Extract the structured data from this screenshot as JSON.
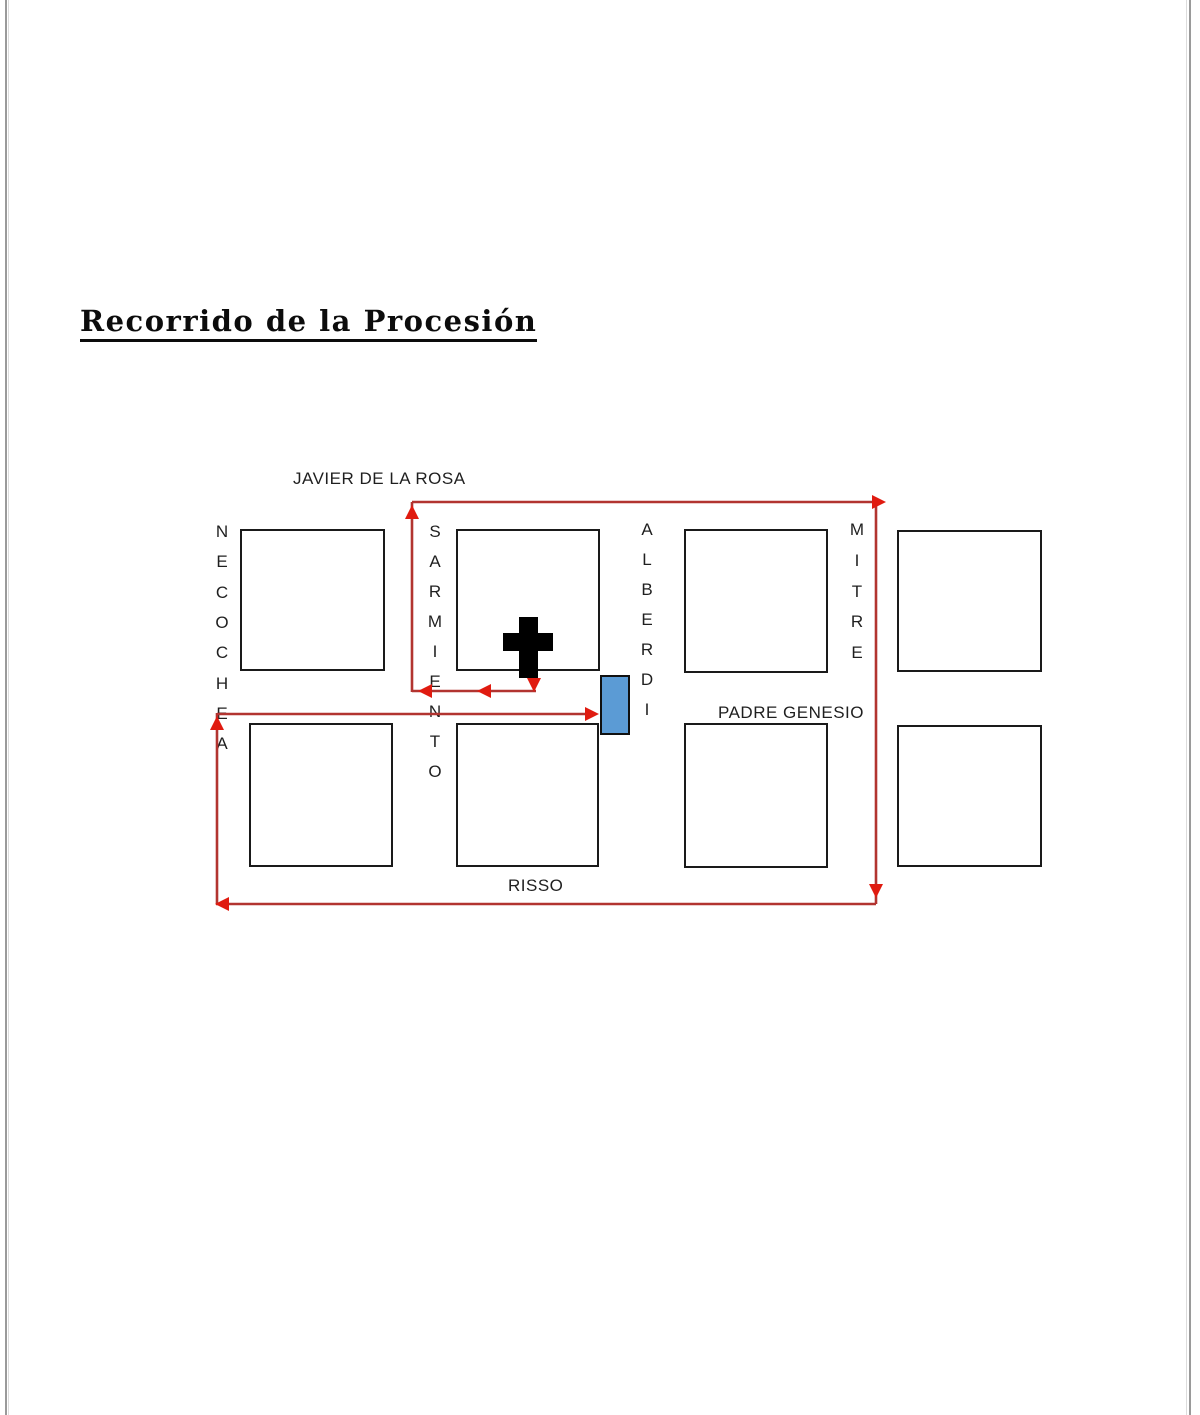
{
  "page": {
    "title": "Recorrido de la Procesión"
  },
  "map": {
    "colors": {
      "route_line": "#b23430",
      "route_arrow": "#e01b10",
      "block_border": "#1a1a1a",
      "block_fill": "#ffffff",
      "cross_fill": "#000000",
      "chapel_fill": "#5b9bd5",
      "chapel_border": "#101010",
      "label_color": "#1f1f1f",
      "page_edge": "#9a9a9a"
    },
    "horizontal_streets": [
      {
        "name": "JAVIER DE LA ROSA"
      },
      {
        "name": "PADRE GENESIO"
      },
      {
        "name": "RISSO"
      }
    ],
    "vertical_streets": [
      {
        "name": "NECOCHEA",
        "x": 222,
        "y_start": 532,
        "spacing": 30.3
      },
      {
        "name": "SARMIENTO",
        "x": 435,
        "y_start": 532,
        "spacing": 30.0
      },
      {
        "name": "ALBERDI",
        "x": 647,
        "y_start": 530,
        "spacing": 30.0
      },
      {
        "name": "MITRE",
        "x": 857,
        "y_start": 530,
        "spacing": 30.75
      }
    ],
    "blocks": [
      {
        "x": 240,
        "y": 529,
        "w": 145,
        "h": 142
      },
      {
        "x": 456,
        "y": 529,
        "w": 144,
        "h": 142
      },
      {
        "x": 684,
        "y": 529,
        "w": 144,
        "h": 144
      },
      {
        "x": 897,
        "y": 530,
        "w": 145,
        "h": 142
      },
      {
        "x": 249,
        "y": 723,
        "w": 144,
        "h": 144
      },
      {
        "x": 456,
        "y": 723,
        "w": 143,
        "h": 144
      },
      {
        "x": 684,
        "y": 723,
        "w": 144,
        "h": 145
      },
      {
        "x": 897,
        "y": 725,
        "w": 145,
        "h": 142
      }
    ],
    "church_cross": {
      "vertical_bar": {
        "x": 519,
        "y": 617,
        "w": 19,
        "h": 61
      },
      "horizontal_bar": {
        "x": 503,
        "y": 633,
        "w": 50,
        "h": 18
      }
    },
    "chapel": {
      "x": 600,
      "y": 675,
      "w": 30,
      "h": 60
    },
    "route": {
      "segments": [
        {
          "x1": 534,
          "y1": 668,
          "x2": 534,
          "y2": 680
        },
        {
          "x1": 412,
          "y1": 691,
          "x2": 536,
          "y2": 691
        },
        {
          "x1": 412,
          "y1": 502,
          "x2": 412,
          "y2": 692
        },
        {
          "x1": 412,
          "y1": 502,
          "x2": 876,
          "y2": 502
        },
        {
          "x1": 876,
          "y1": 502,
          "x2": 876,
          "y2": 904
        },
        {
          "x1": 216,
          "y1": 904,
          "x2": 876,
          "y2": 904
        },
        {
          "x1": 217,
          "y1": 713,
          "x2": 217,
          "y2": 904
        },
        {
          "x1": 217,
          "y1": 714,
          "x2": 590,
          "y2": 714
        }
      ],
      "arrows": [
        {
          "x": 534,
          "y": 692,
          "dir": "down"
        },
        {
          "x": 477,
          "y": 691,
          "dir": "left"
        },
        {
          "x": 418,
          "y": 691,
          "dir": "left"
        },
        {
          "x": 412,
          "y": 505,
          "dir": "up"
        },
        {
          "x": 886,
          "y": 502,
          "dir": "right"
        },
        {
          "x": 876,
          "y": 898,
          "dir": "down"
        },
        {
          "x": 215,
          "y": 904,
          "dir": "left"
        },
        {
          "x": 217,
          "y": 716,
          "dir": "up"
        },
        {
          "x": 599,
          "y": 714,
          "dir": "right"
        }
      ]
    }
  }
}
